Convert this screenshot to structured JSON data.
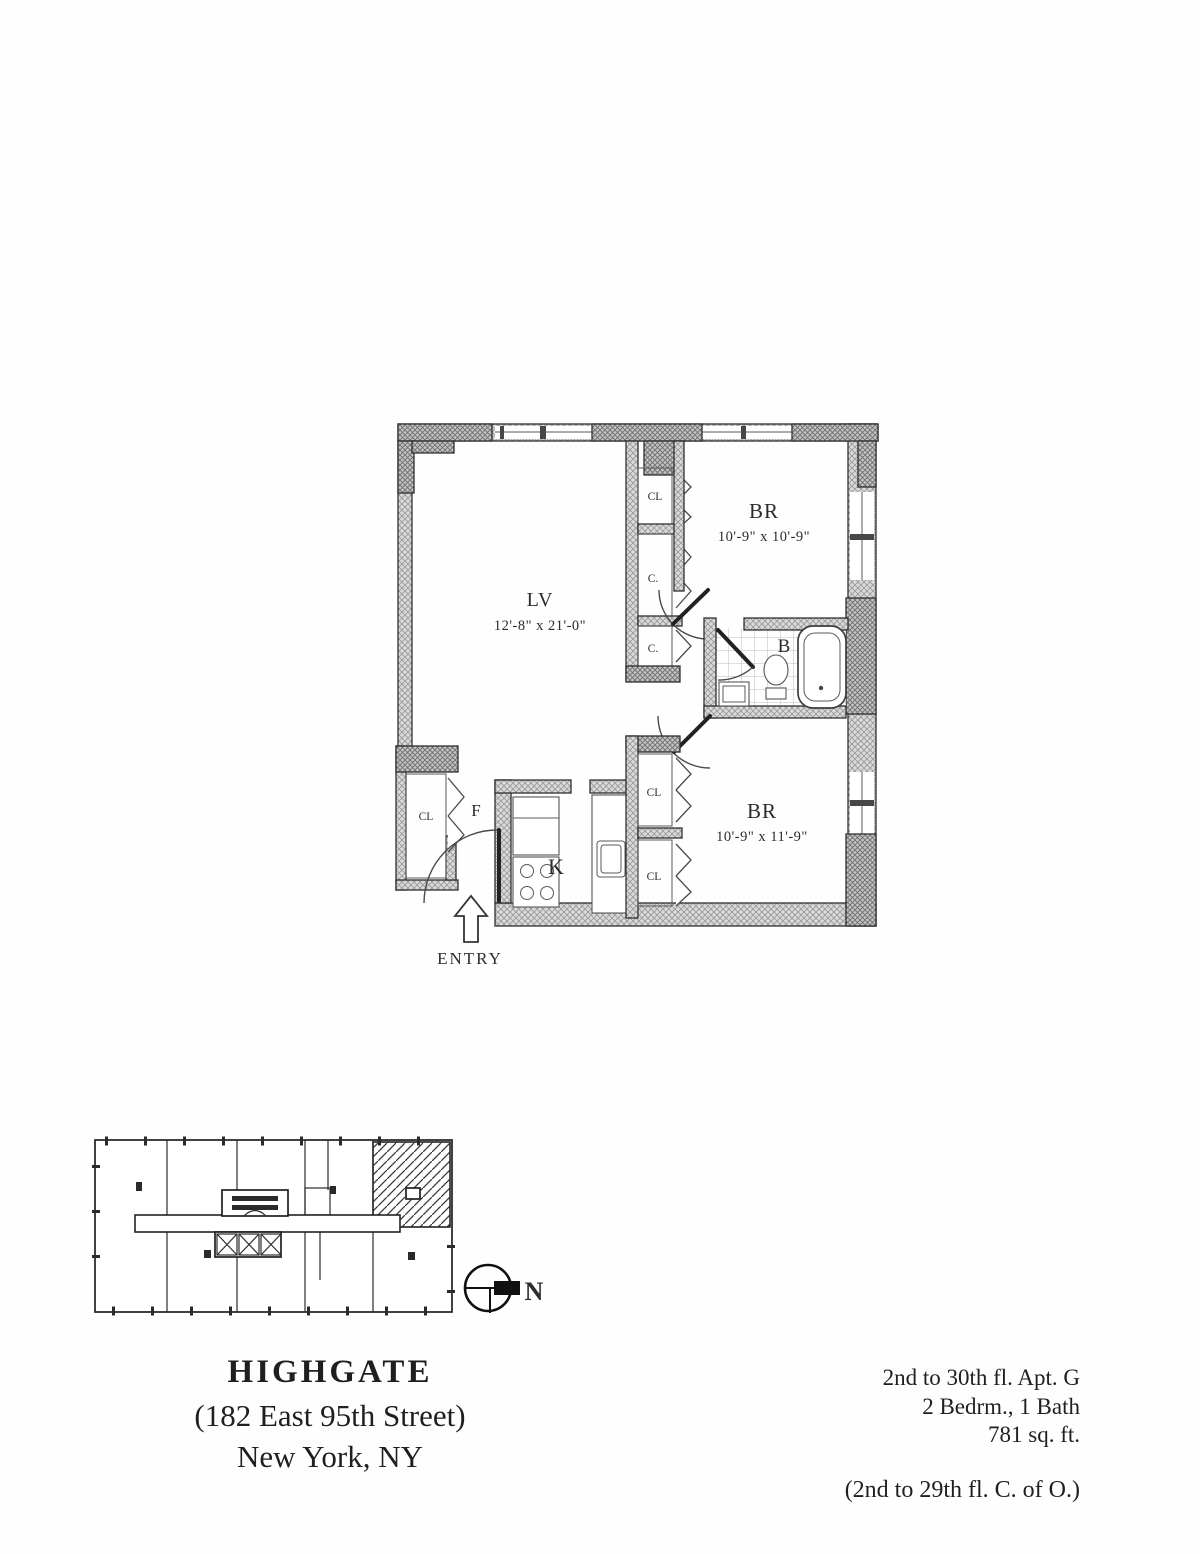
{
  "document": {
    "building_name": "HIGHGATE",
    "address": "(182 East 95th Street)",
    "city": "New York, NY",
    "unit_lines": {
      "floors_apt": "2nd to 30th fl. Apt. G",
      "bed_bath": "2 Bedrm., 1 Bath",
      "area": "781 sq. ft.",
      "certificate": "(2nd to 29th fl. C. of O.)"
    }
  },
  "floor_plan": {
    "entry_label": "ENTRY",
    "living_room": {
      "label": "LV",
      "dims": "12'-8\" x 21'-0\""
    },
    "bedroom_top": {
      "label": "BR",
      "dims": "10'-9\" x 10'-9\""
    },
    "bedroom_bottom": {
      "label": "BR",
      "dims": "10'-9\" x 11'-9\""
    },
    "bathroom_label": "B",
    "kitchen_label": "K",
    "foyer_label": "F",
    "foyer_closet_label": "CL",
    "hall_closets": {
      "c1": "CL",
      "c2": "C.",
      "c3": "C."
    },
    "bedroom_closets": {
      "c1": "CL",
      "c2": "CL"
    }
  },
  "key_plan": {
    "north_label": "N"
  },
  "colors": {
    "ink": "#2b2b2b",
    "wall_gray": "#9a9a9a",
    "paper": "#fefefe"
  }
}
